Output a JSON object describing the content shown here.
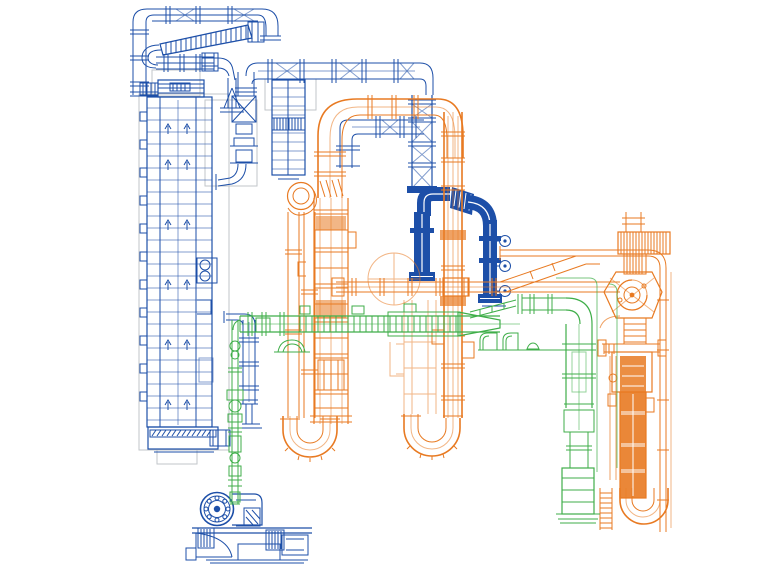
{
  "drawing": {
    "kind": "cad-piping-isometric-wireframe",
    "canvas": {
      "width": 768,
      "height": 572
    },
    "background": "#ffffff"
  },
  "colors": {
    "blue": "#1d4fa8",
    "orange": "#e87a22",
    "green": "#3fae49",
    "gray": "#c2c6ca",
    "bg": "#ffffff"
  },
  "systems": [
    {
      "id": "blue-line",
      "color": "#1d4fa8",
      "components": [
        "top-pipe-run",
        "screw-conveyor",
        "bucket-elevator-tower",
        "lattice-duct-column",
        "bold-gooseneck-pipe",
        "drop-pipe",
        "mill-blower-machine"
      ]
    },
    {
      "id": "orange-line",
      "color": "#e87a22",
      "components": [
        "arch-duct",
        "process-column",
        "fan-volute",
        "u-bend-left",
        "main-riser",
        "u-bend-center",
        "transfer-duct",
        "cyclone-tower",
        "tower-u-bend",
        "return-duct"
      ]
    },
    {
      "id": "green-line",
      "color": "#3fae49",
      "components": [
        "screw-conveyor-horizontal",
        "drop-leg-with-valves",
        "right-elbow-duct",
        "right-column",
        "thin-route-line",
        "dome-fittings"
      ]
    }
  ]
}
